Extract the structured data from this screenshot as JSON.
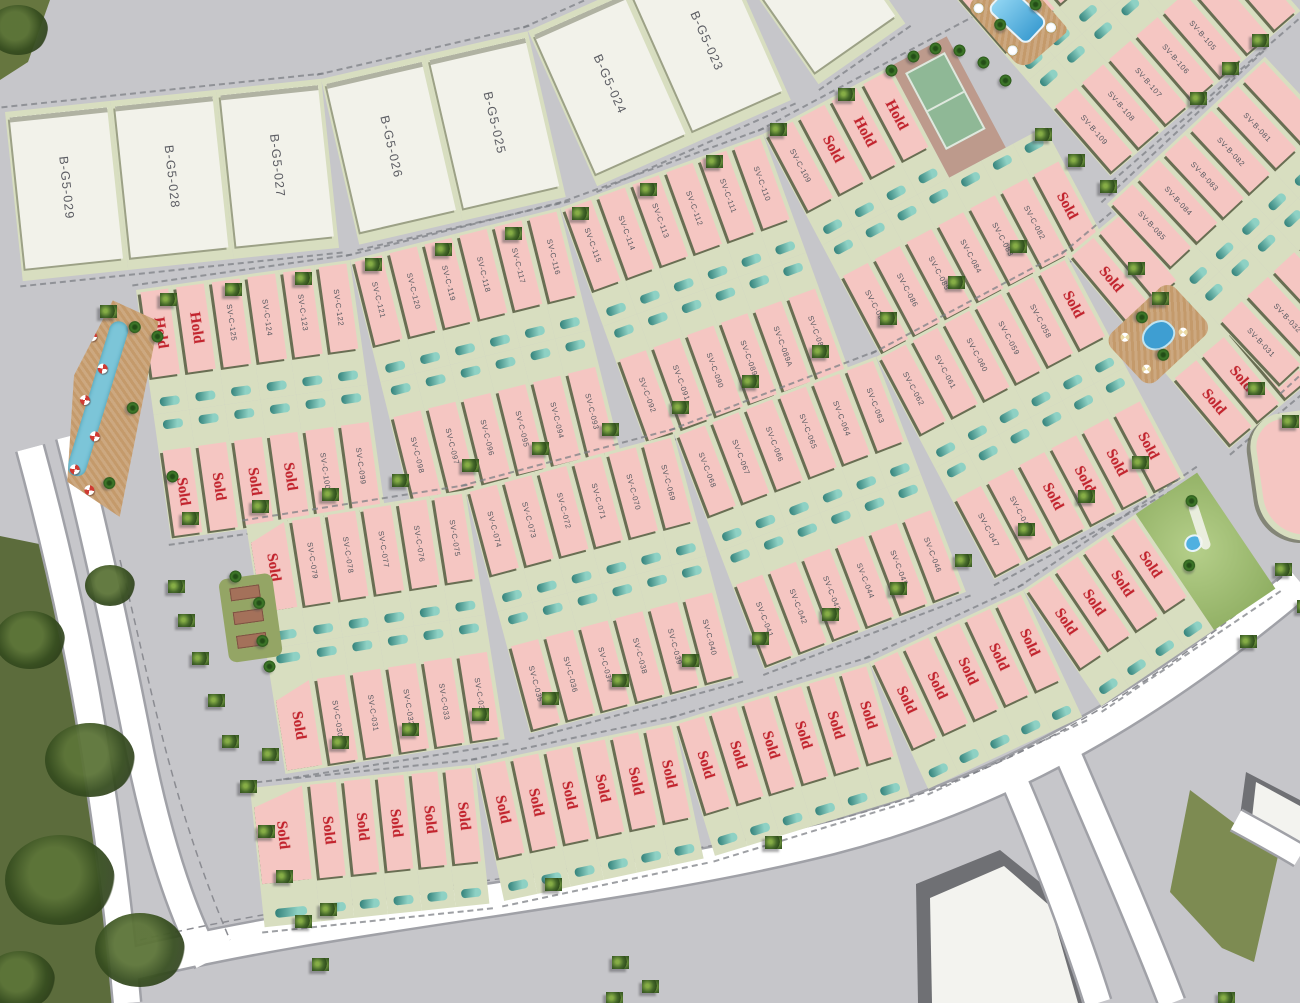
{
  "map": {
    "background": "#c6c6ca",
    "colors": {
      "plot_pink": "#f5c6c2",
      "plot_white": "#f2f2ea",
      "yard_green": "#d8dec0",
      "divider_dark": "#65694f",
      "pool_teal_light": "#8ed1c4",
      "pool_teal_dark": "#2f7e77",
      "status_red": "#c3242e",
      "plot_label_gray": "#55575e",
      "road_white": "#ffffff",
      "park_green": "#5c6c3c",
      "water_blue": "#7cc5d8",
      "deck_tan": "#c49a6b",
      "court_green": "#8fb896",
      "court_base": "#bd9a8c"
    },
    "status_labels": {
      "sold": "Sold",
      "hold": "Hold"
    },
    "bands": [
      {
        "name": "block-bg5",
        "style": "white",
        "rows": 1,
        "pw": 106,
        "h": 170,
        "segments": [
          {
            "x": 5,
            "y": 112,
            "rot": -6,
            "plots": [
              "B-G5-029",
              "B-G5-028",
              "B-G5-027"
            ]
          },
          {
            "x": 321,
            "y": 79,
            "rot": -13,
            "plots": [
              "B-G5-026",
              "B-G5-025"
            ]
          },
          {
            "x": 528,
            "y": 31,
            "rot": -24,
            "plots": [
              "B-G5-024",
              "B-G5-023"
            ]
          },
          {
            "x": 721,
            "y": -55,
            "rot": -35,
            "plots": [
              ""
            ]
          }
        ]
      },
      {
        "name": "block-svc-north",
        "style": "pink",
        "rows": 2,
        "pw": 36,
        "h": 252,
        "segments": [
          {
            "x": 136,
            "y": 290,
            "rot": -8,
            "top": [
              "Hold",
              "Hold",
              "SV-C-125",
              "SV-C-124",
              "SV-C-123",
              "SV-C-122"
            ],
            "bottom": [
              "Sold",
              "Sold",
              "Sold",
              "Sold",
              "SV-C-100",
              "SV-C-099"
            ]
          },
          {
            "x": 350,
            "y": 260,
            "rot": -14,
            "top": [
              "SV-C-121",
              "SV-C-120",
              "SV-C-119",
              "SV-C-118",
              "SV-C-117",
              "SV-C-116"
            ],
            "bottom": [
              "SV-C-098",
              "SV-C-097",
              "SV-C-096",
              "SV-C-095",
              "SV-C-094",
              "SV-C-093"
            ]
          },
          {
            "x": 560,
            "y": 208,
            "rot": -20,
            "top": [
              "SV-C-115",
              "SV-C-114",
              "SV-C-113",
              "SV-C-112",
              "SV-C-111",
              "SV-C-110"
            ],
            "bottom": [
              "SV-C-092",
              "SV-C-091",
              "SV-C-090",
              "SV-C-089",
              "SV-C-089A",
              "SV-C-088"
            ]
          },
          {
            "x": 763,
            "y": 134,
            "rot": -28,
            "top": [
              "SV-C-109",
              "Sold",
              "Hold",
              "Hold",
              {
                "t": "court",
                "w": 64
              }
            ],
            "bottom": [
              "SV-C-087",
              "SV-C-086",
              "SV-C-085",
              "SV-C-084",
              "SV-C-083",
              "SV-C-082",
              "Sold"
            ]
          }
        ]
      },
      {
        "name": "block-svc-south",
        "style": "pink",
        "rows": 2,
        "pw": 36,
        "h": 252,
        "segments": [
          {
            "x": 246,
            "y": 525,
            "rot": -9,
            "top": [
              {
                "l": "Sold",
                "w": 42,
                "wedge": true
              },
              "SV-C-079",
              "SV-C-078",
              "SV-C-077",
              "SV-C-076",
              "SV-C-075"
            ],
            "bottom": [
              {
                "l": "Sold",
                "w": 42,
                "wedge": true
              },
              "SV-C-030",
              "SV-C-031",
              "SV-C-032",
              "SV-C-033",
              "SV-C-034"
            ]
          },
          {
            "x": 465,
            "y": 490,
            "rot": -15,
            "top": [
              "SV-C-074",
              "SV-C-073",
              "SV-C-072",
              "SV-C-071",
              "SV-C-070",
              "SV-C-069"
            ],
            "bottom": [
              "SV-C-035",
              "SV-C-036",
              "SV-C-037",
              "SV-C-038",
              "SV-C-039",
              "SV-C-040"
            ]
          },
          {
            "x": 674,
            "y": 434,
            "rot": -21,
            "top": [
              "SV-C-068",
              "SV-C-067",
              "SV-C-066",
              "SV-C-065",
              "SV-C-064",
              "SV-C-063"
            ],
            "bottom": [
              "SV-C-041",
              "SV-C-042",
              "SV-C-043",
              "SV-C-044",
              "SV-C-045",
              "SV-C-046"
            ]
          },
          {
            "x": 876,
            "y": 357,
            "rot": -28,
            "top": [
              "SV-C-062",
              "SV-C-061",
              "SV-C-060",
              "SV-C-059",
              "SV-C-058",
              "Sold"
            ],
            "bottom": [
              "SV-C-047",
              "SV-C-048",
              "Sold",
              "Sold",
              "Sold",
              "Sold"
            ]
          },
          {
            "x": 1067,
            "y": 256,
            "rot": -40,
            "top": [
              "Sold",
              ""
            ],
            "bottom": [
              "Sold",
              "Sold",
              "Sold"
            ]
          }
        ]
      },
      {
        "name": "block-svc-lane",
        "style": "pink",
        "rows": 1,
        "pw": 34,
        "h": 140,
        "segments": [
          {
            "x": 250,
            "y": 788,
            "rot": -6,
            "plots": [
              {
                "l": "Sold",
                "w": 56,
                "wedge": true
              },
              "Sold",
              "Sold",
              "Sold",
              "Sold",
              "Sold"
            ]
          },
          {
            "x": 475,
            "y": 764,
            "rot": -12,
            "plots": [
              "Sold",
              "Sold",
              "Sold",
              "Sold",
              "Sold",
              "Sold"
            ]
          },
          {
            "x": 674,
            "y": 722,
            "rot": -17,
            "plots": [
              "Sold",
              "Sold",
              "Sold",
              "Sold",
              "Sold",
              "Sold"
            ]
          },
          {
            "x": 869,
            "y": 662,
            "rot": -25,
            "plots": [
              "Sold",
              "Sold",
              "Sold",
              "Sold",
              "Sold"
            ]
          },
          {
            "x": 1023,
            "y": 590,
            "rot": -34,
            "plots": [
              "Sold",
              "Sold",
              "Sold",
              "Sold",
              {
                "t": "park",
                "w": 74
              }
            ]
          }
        ]
      },
      {
        "name": "block-svb-north",
        "style": "pink",
        "rows": 2,
        "pw": 36,
        "h": 252,
        "segments": [
          {
            "x": 945,
            "y": -14,
            "rot": -41,
            "top": [
              "",
              "SV-B-110",
              "",
              "",
              ""
            ],
            "bottom": [
              "SV-B-109",
              "SV-B-108",
              "SV-B-107",
              "SV-B-106",
              "SV-B-105",
              "",
              ""
            ]
          }
        ]
      },
      {
        "name": "block-svb-east",
        "style": "pink",
        "rows": 2,
        "pw": 36,
        "h": 252,
        "segments": [
          {
            "x": 1107,
            "y": 204,
            "rot": -43,
            "top": [
              "SV-B-085",
              "SV-B-084",
              "SV-B-083",
              "SV-B-082",
              "SV-B-081",
              ""
            ],
            "bottom": [
              "SV-B-031",
              "SV-B-032",
              "SV-B-033",
              "",
              ""
            ]
          }
        ]
      }
    ],
    "amenities": [
      {
        "type": "river-pool",
        "name": "lazy-river-pool-area",
        "x": 88,
        "y": 296,
        "w": 74,
        "h": 212,
        "rot": 10
      },
      {
        "type": "garden",
        "name": "garden-amenity",
        "x": 218,
        "y": 580,
        "w": 54,
        "h": 84,
        "rot": -8
      },
      {
        "type": "pool",
        "name": "community-pool-north",
        "x": 966,
        "y": 6,
        "w": 62,
        "h": 86,
        "rot": -41
      },
      {
        "type": "pool2",
        "name": "community-pool-east",
        "x": 1168,
        "y": 280,
        "w": 66,
        "h": 88,
        "rot": 47
      },
      {
        "type": "band-end",
        "name": "block-end-plot",
        "x": 1246,
        "y": 418,
        "w": 110,
        "h": 118,
        "rot": -8
      }
    ],
    "shapes": [
      {
        "n": "park-main",
        "clip": "polygon(0px 536px, 44px 545px, 76px 630px, 96px 740px, 112px 860px, 118px 1003px, 0px 1003px)",
        "fill": "#5c6c3c"
      },
      {
        "n": "park-corner",
        "clip": "polygon(0px 0px, 50px 0px, 28px 62px, 0px 80px)",
        "fill": "#66763f"
      },
      {
        "n": "green-patch",
        "clip": "polygon(1190px 790px, 1278px 856px, 1254px 962px, 1222px 948px, 1170px 892px)",
        "fill": "#7d8b52"
      },
      {
        "n": "building-a-shadow",
        "clip": "polygon(916px 884px, 1000px 850px, 1052px 892px, 1082px 1003px, 918px 1003px)",
        "fill": "#6f7074"
      },
      {
        "n": "building-a",
        "clip": "polygon(930px 898px, 1004px 866px, 1050px 906px, 1078px 1003px, 932px 1003px)",
        "fill": "#f3f3ef"
      },
      {
        "n": "building-b-shadow",
        "clip": "polygon(1246px 772px, 1300px 800px, 1300px 852px, 1240px 816px)",
        "fill": "#6f7074"
      },
      {
        "n": "building-b",
        "clip": "polygon(1256px 782px, 1300px 806px, 1300px 848px, 1252px 818px)",
        "fill": "#f3f3ef"
      }
    ],
    "canopies": [
      [
        30,
        640,
        70
      ],
      [
        90,
        760,
        90
      ],
      [
        60,
        880,
        110
      ],
      [
        140,
        950,
        90
      ],
      [
        20,
        980,
        70
      ],
      [
        110,
        585,
        50
      ],
      [
        18,
        30,
        60
      ]
    ],
    "trees": [
      [
        100,
        305
      ],
      [
        160,
        293
      ],
      [
        225,
        283
      ],
      [
        295,
        272
      ],
      [
        365,
        258
      ],
      [
        435,
        243
      ],
      [
        505,
        227
      ],
      [
        572,
        207
      ],
      [
        640,
        183
      ],
      [
        706,
        155
      ],
      [
        770,
        123
      ],
      [
        838,
        88
      ],
      [
        182,
        512
      ],
      [
        252,
        500
      ],
      [
        322,
        488
      ],
      [
        392,
        474
      ],
      [
        462,
        459
      ],
      [
        532,
        442
      ],
      [
        602,
        423
      ],
      [
        672,
        401
      ],
      [
        742,
        375
      ],
      [
        812,
        345
      ],
      [
        880,
        312
      ],
      [
        948,
        276
      ],
      [
        1010,
        240
      ],
      [
        262,
        748
      ],
      [
        332,
        736
      ],
      [
        402,
        723
      ],
      [
        472,
        708
      ],
      [
        542,
        692
      ],
      [
        612,
        674
      ],
      [
        682,
        654
      ],
      [
        752,
        632
      ],
      [
        822,
        608
      ],
      [
        890,
        582
      ],
      [
        955,
        554
      ],
      [
        1018,
        523
      ],
      [
        1078,
        490
      ],
      [
        1132,
        456
      ],
      [
        168,
        580
      ],
      [
        178,
        614
      ],
      [
        192,
        652
      ],
      [
        208,
        694
      ],
      [
        222,
        735
      ],
      [
        240,
        780
      ],
      [
        258,
        825
      ],
      [
        276,
        870
      ],
      [
        295,
        915
      ],
      [
        312,
        958
      ],
      [
        1035,
        128
      ],
      [
        1068,
        154
      ],
      [
        1100,
        180
      ],
      [
        1190,
        92
      ],
      [
        1222,
        62
      ],
      [
        1252,
        34
      ],
      [
        1128,
        262
      ],
      [
        1152,
        292
      ],
      [
        1248,
        382
      ],
      [
        1282,
        415
      ],
      [
        1275,
        563
      ],
      [
        1297,
        600
      ],
      [
        320,
        903
      ],
      [
        545,
        878
      ],
      [
        765,
        836
      ],
      [
        1240,
        635
      ],
      [
        612,
        956
      ],
      [
        642,
        980
      ],
      [
        606,
        992
      ],
      [
        1218,
        992
      ]
    ],
    "palms": [
      [
        884,
        64
      ],
      [
        906,
        50
      ],
      [
        928,
        42
      ],
      [
        952,
        44
      ],
      [
        976,
        56
      ],
      [
        998,
        74
      ],
      [
        228,
        570
      ],
      [
        262,
        660
      ],
      [
        150,
        330
      ],
      [
        165,
        470
      ]
    ]
  }
}
